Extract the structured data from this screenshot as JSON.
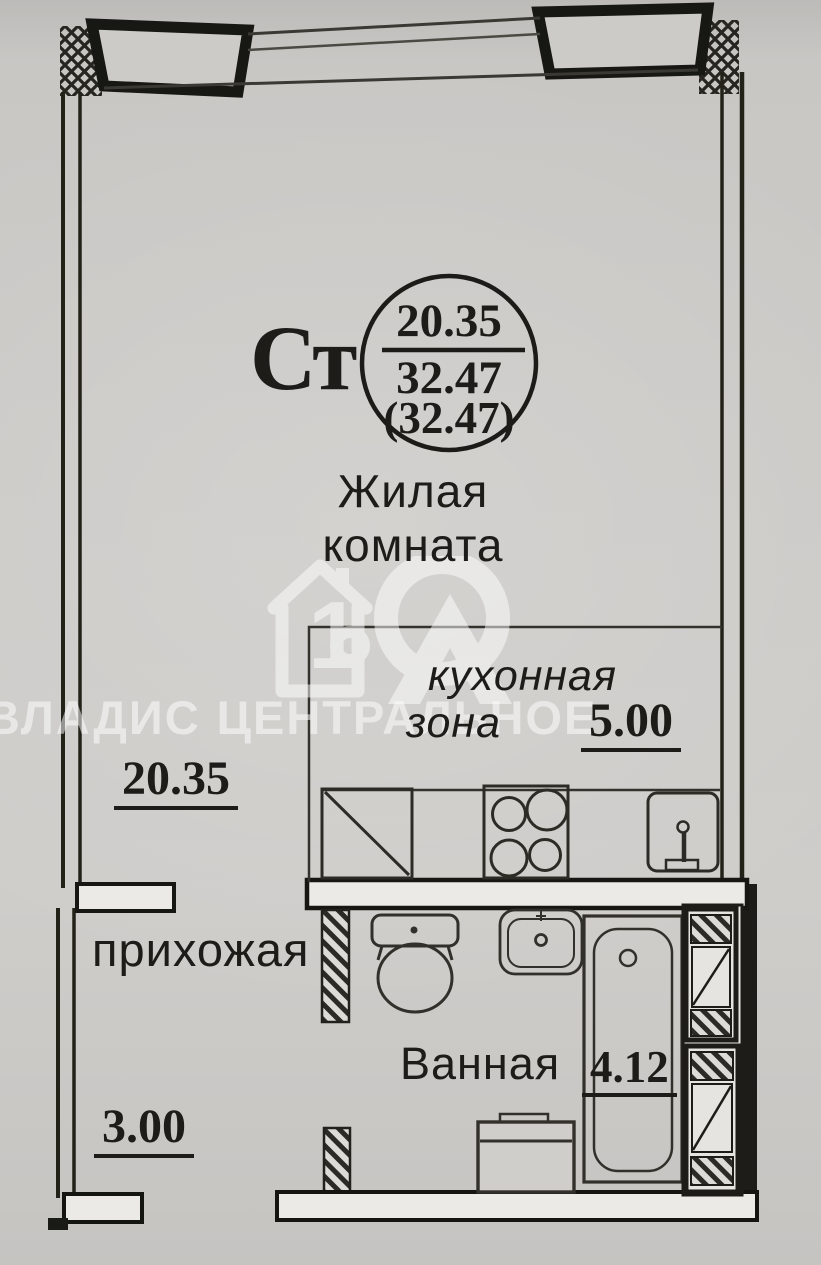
{
  "stamp": {
    "type_label": "Ст",
    "living_area": "20.35",
    "total_area": "32.47",
    "total_area_with_balcony": "(32.47)"
  },
  "rooms": {
    "living": {
      "label_line1": "Жилая",
      "label_line2": "комната",
      "area": "20.35"
    },
    "kitchen": {
      "label_line1": "кухонная",
      "label_line2": "зона",
      "area": "5.00"
    },
    "hallway": {
      "label": "прихожая",
      "area": "3.00"
    },
    "bathroom": {
      "label": "Ванная",
      "area": "4.12"
    }
  },
  "watermark": {
    "logo": "house-10-logo",
    "brand_left": "ВЛАДИС",
    "brand_right": "ЦЕНТРАЛЬНОЕ"
  }
}
